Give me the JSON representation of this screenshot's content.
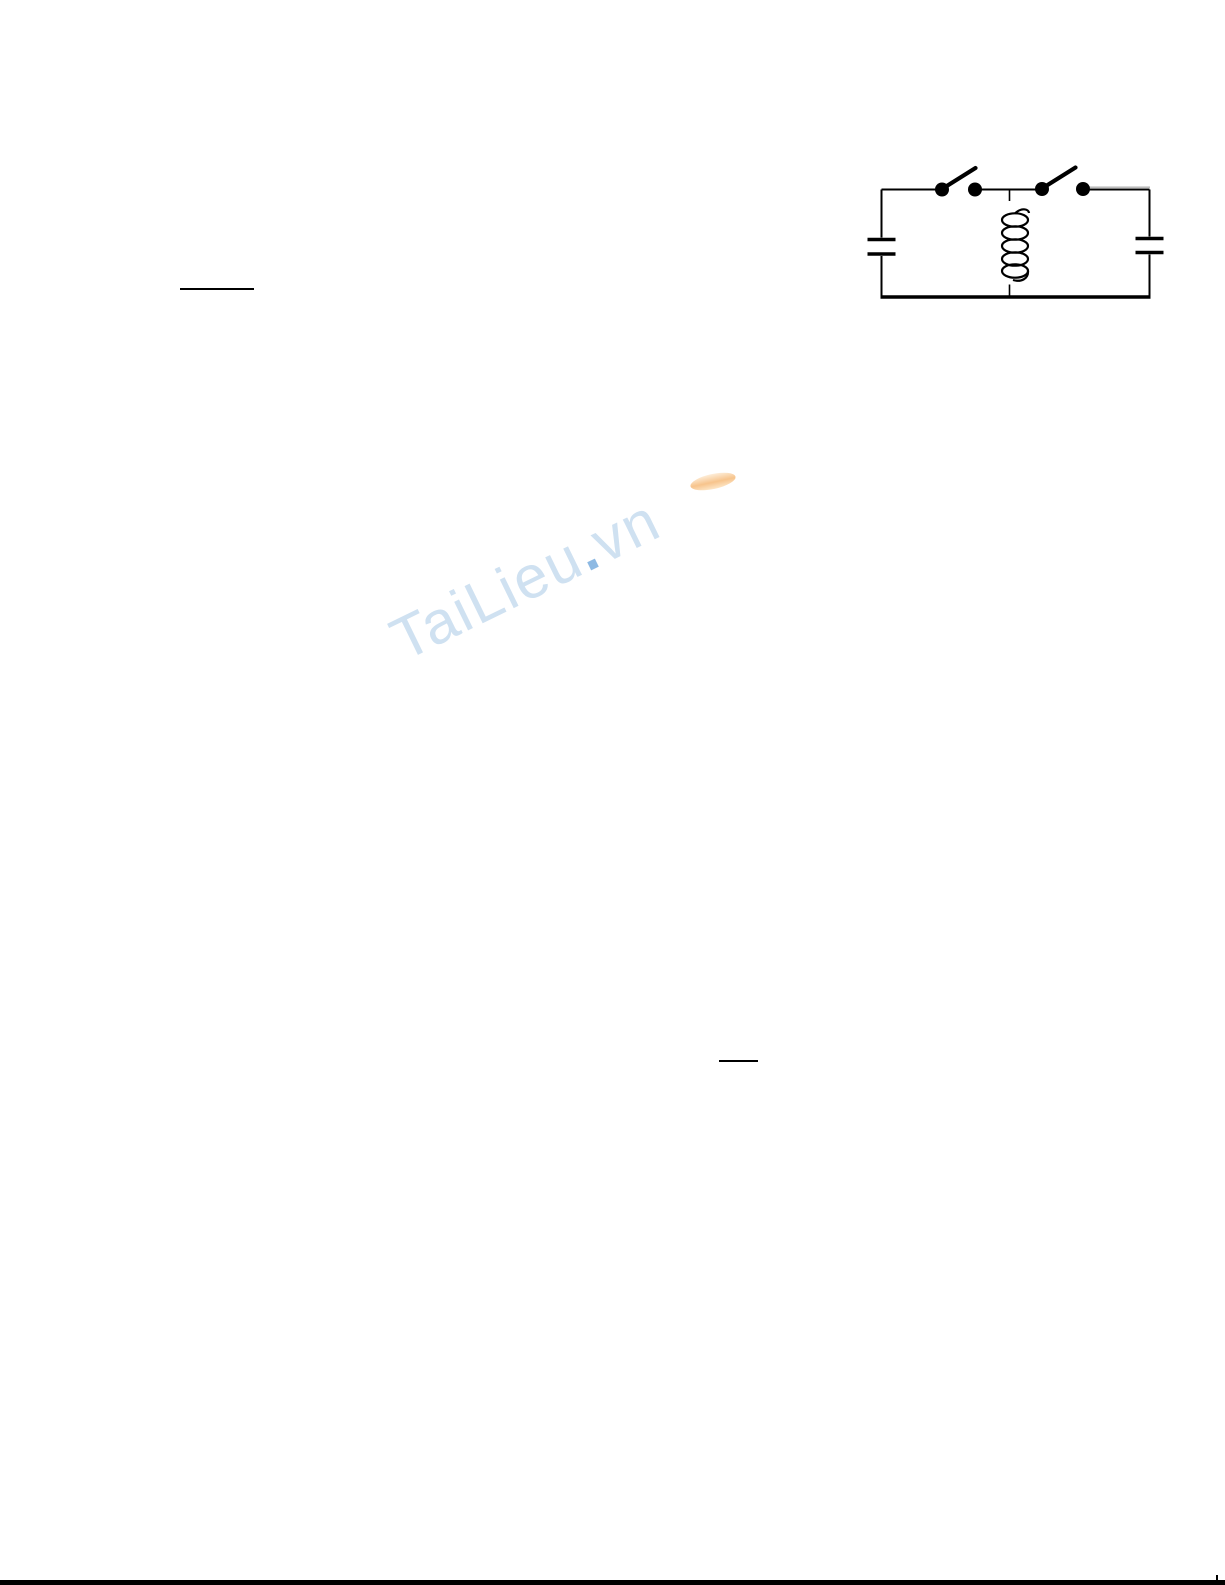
{
  "page": {
    "background": "#ffffff"
  },
  "watermark": {
    "text_main": "TaiLieu",
    "text_dot": ".",
    "text_suffix": "vn",
    "color_main": "#cfe1f1",
    "color_dot": "#8db9e3",
    "color_swoosh": "#f6bd7f"
  },
  "figure": {
    "ink_color": "#000000",
    "components": [
      "capacitor-left",
      "open-switch-left",
      "inductor-coil",
      "open-switch-right",
      "capacitor-right"
    ]
  },
  "footer": {
    "bar_color": "#000000"
  }
}
